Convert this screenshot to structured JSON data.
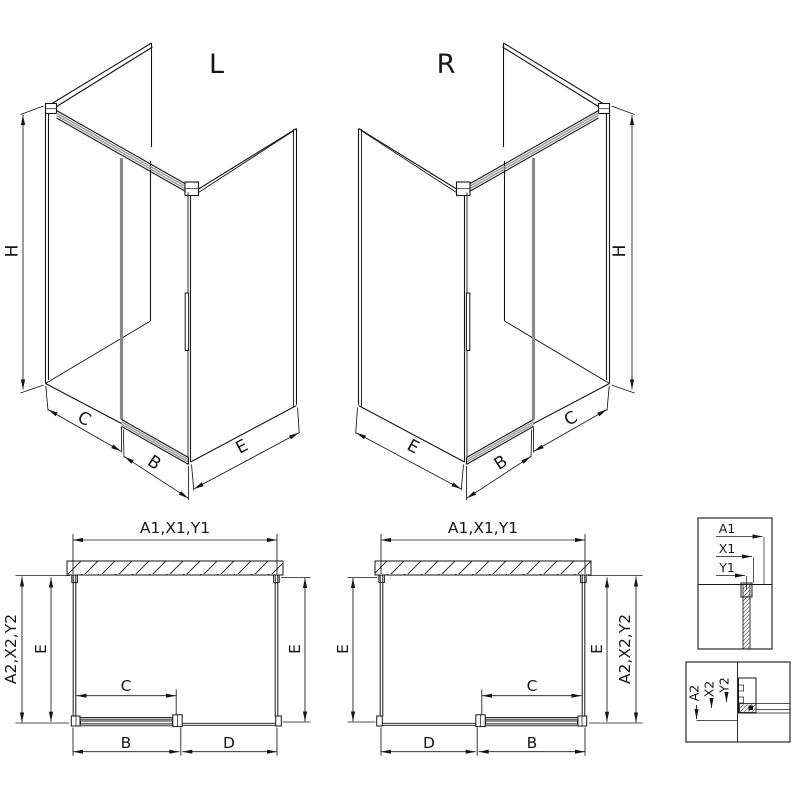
{
  "iso_left": {
    "title": "L",
    "dim_height": "H",
    "dim_fixed_width": "C",
    "dim_door_width": "B",
    "dim_depth": "E"
  },
  "iso_right": {
    "title": "R",
    "dim_height": "H",
    "dim_fixed_width": "C",
    "dim_door_width": "B",
    "dim_depth": "E"
  },
  "plan_left": {
    "dim_top": "A1,X1,Y1",
    "dim_side": "A2,X2,Y2",
    "dim_depth_left": "E",
    "dim_depth_right": "E",
    "dim_opening": "C",
    "dim_door": "B",
    "dim_open_side": "D"
  },
  "plan_right": {
    "dim_top": "A1,X1,Y1",
    "dim_side": "A2,X2,Y2",
    "dim_depth_left": "E",
    "dim_depth_right": "E",
    "dim_opening": "C",
    "dim_door": "B",
    "dim_open_side": "D"
  },
  "detail_wall_profile": {
    "labels": [
      "A1",
      "X1",
      "Y1"
    ]
  },
  "detail_floor_profile": {
    "labels": [
      "A2",
      "X2",
      "Y2"
    ]
  },
  "colors": {
    "line": "#161616",
    "door_gray": "#8a8a8a",
    "rail_gray": "#9a9a9a"
  }
}
